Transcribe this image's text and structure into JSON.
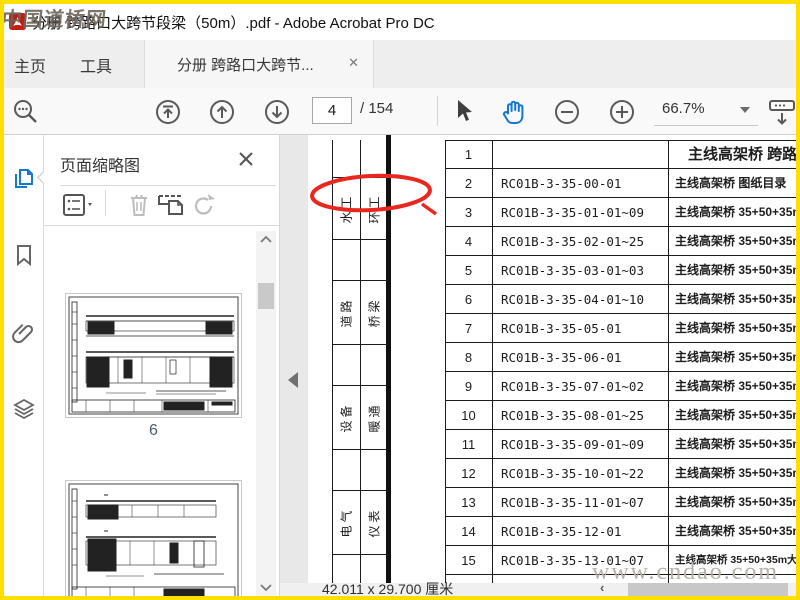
{
  "window": {
    "title": "分册 跨路口大跨节段梁（50m）.pdf - Adobe Acrobat Pro DC",
    "watermark_top": "中国道桥网",
    "watermark_bottom": "www.cndao.com"
  },
  "tabs": {
    "home": "主页",
    "tools": "工具",
    "document": "分册 跨路口大跨节...",
    "close": "✕"
  },
  "toolbar": {
    "page_current": "4",
    "page_total": "/ 154",
    "zoom_level": "66.7%"
  },
  "panel": {
    "title": "页面缩略图",
    "thumb1_label": "6"
  },
  "statusbar": {
    "page_size": "42.011 x 29.700 厘米"
  },
  "document": {
    "margin_labels": [
      {
        "left": "水工",
        "right": "环工"
      },
      {
        "left": "道路",
        "right": "桥梁"
      },
      {
        "left": "设备",
        "right": "暖通"
      },
      {
        "left": "电气",
        "right": "仪表"
      }
    ],
    "rows": [
      {
        "no": "1",
        "code": "",
        "desc": "主线高架桥 跨路口",
        "title": true
      },
      {
        "no": "2",
        "code": "RC01B-3-35-00-01",
        "desc": "主线高架桥 图纸目录"
      },
      {
        "no": "3",
        "code": "RC01B-3-35-01-01~09",
        "desc": "主线高架桥 35+50+35m大跨节段梁(B=25m"
      },
      {
        "no": "4",
        "code": "RC01B-3-35-02-01~25",
        "desc": "主线高架桥 35+50+35m大跨节段梁(B=25m"
      },
      {
        "no": "5",
        "code": "RC01B-3-35-03-01~03",
        "desc": "主线高架桥 35+50+35m大跨节段梁(B=25m"
      },
      {
        "no": "6",
        "code": "RC01B-3-35-04-01~10",
        "desc": "主线高架桥 35+50+35m大跨节段梁(B=25m"
      },
      {
        "no": "7",
        "code": "RC01B-3-35-05-01",
        "desc": "主线高架桥 35+50+35m大跨节段梁(B=25m"
      },
      {
        "no": "8",
        "code": "RC01B-3-35-06-01",
        "desc": "主线高架桥 35+50+35m大跨节段梁(B=25m"
      },
      {
        "no": "9",
        "code": "RC01B-3-35-07-01~02",
        "desc": "主线高架桥 35+50+35m大跨节段梁(B=25m"
      },
      {
        "no": "10",
        "code": "RC01B-3-35-08-01~25",
        "desc": "主线高架桥 35+50+35m大跨节段梁(B=25m"
      },
      {
        "no": "11",
        "code": "RC01B-3-35-09-01~09",
        "desc": "主线高架桥 35+50+35m大跨节段梁(B=25m"
      },
      {
        "no": "12",
        "code": "RC01B-3-35-10-01~22",
        "desc": "主线高架桥 35+50+35m大跨节段梁(B=25m"
      },
      {
        "no": "13",
        "code": "RC01B-3-35-11-01~07",
        "desc": "主线高架桥 35+50+35m大跨节段梁(B=25m"
      },
      {
        "no": "14",
        "code": "RC01B-3-35-12-01",
        "desc": "主线高架桥 35+50+35m大跨节段梁(B=25m"
      },
      {
        "no": "15",
        "code": "RC01B-3-35-13-01~07",
        "desc": "主线高架桥 35+50+35m大跨节段梁(B=25m) 预应",
        "small": true
      },
      {
        "no": "",
        "code": "",
        "desc": ""
      }
    ]
  },
  "colors": {
    "accent_blue": "#1377d4",
    "annotation_red": "#e8281e",
    "frame_yellow": "#ffdf00"
  }
}
